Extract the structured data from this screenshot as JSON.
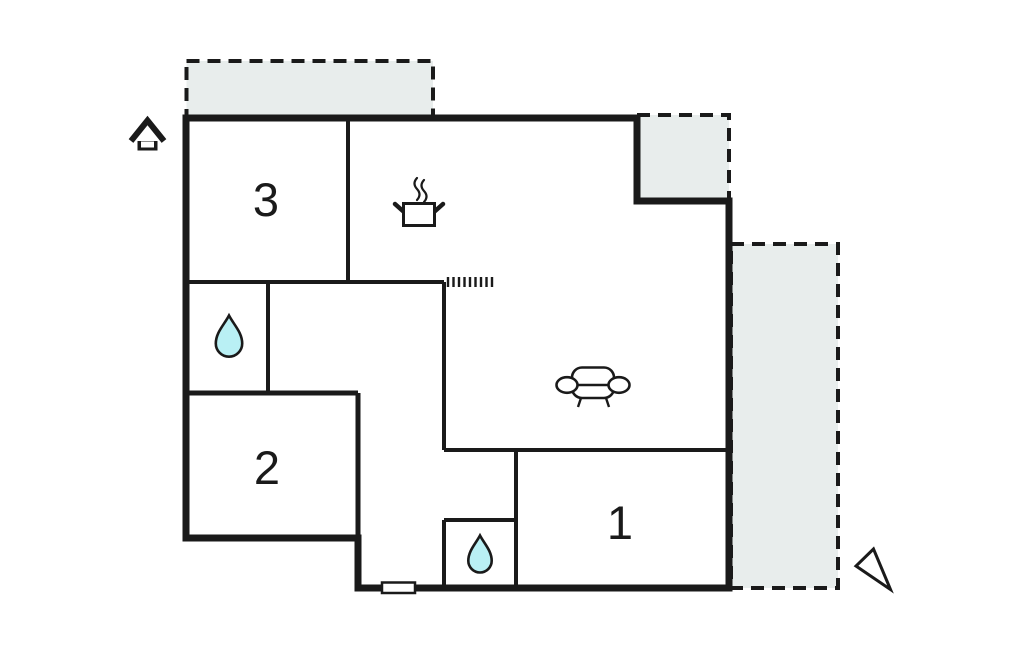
{
  "colors": {
    "wall": "#1a1a1a",
    "terrace_fill": "#e8edec",
    "water_drop": "#b9f0f4",
    "white": "#ffffff"
  },
  "rooms": [
    {
      "label": "3"
    },
    {
      "label": "2"
    },
    {
      "label": "1"
    }
  ],
  "icons": {
    "entrance": "house-icon",
    "kitchen": "stove-pot-icon",
    "bathrooms": "water-drop-icon",
    "living_area": "sofa-icon",
    "orientation": "north-arrow-icon",
    "opening": "hatch-marks",
    "window": "window-marker"
  }
}
